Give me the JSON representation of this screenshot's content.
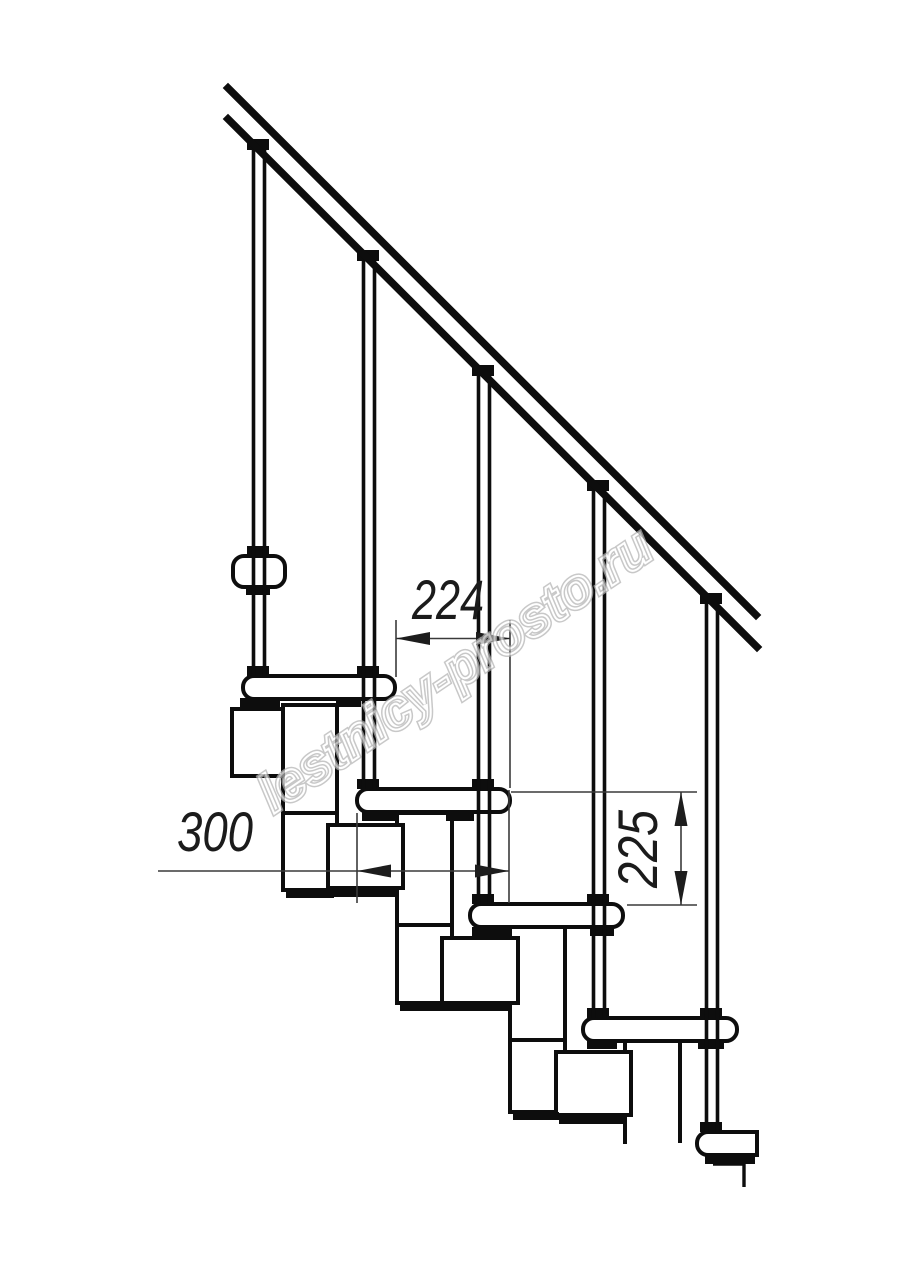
{
  "drawing": {
    "title": "Modular staircase side elevation technical drawing",
    "watermark_text": "lestnicy-prosto.ru",
    "dimensions": {
      "step_run": "224",
      "tread_depth": "300",
      "step_rise": "225"
    },
    "colors": {
      "background": "#ffffff",
      "line": "#0d0d0d",
      "dimension_line": "#3a3a3a",
      "dimension_text": "#1b1b1b",
      "watermark": "#b3b3b3"
    }
  }
}
